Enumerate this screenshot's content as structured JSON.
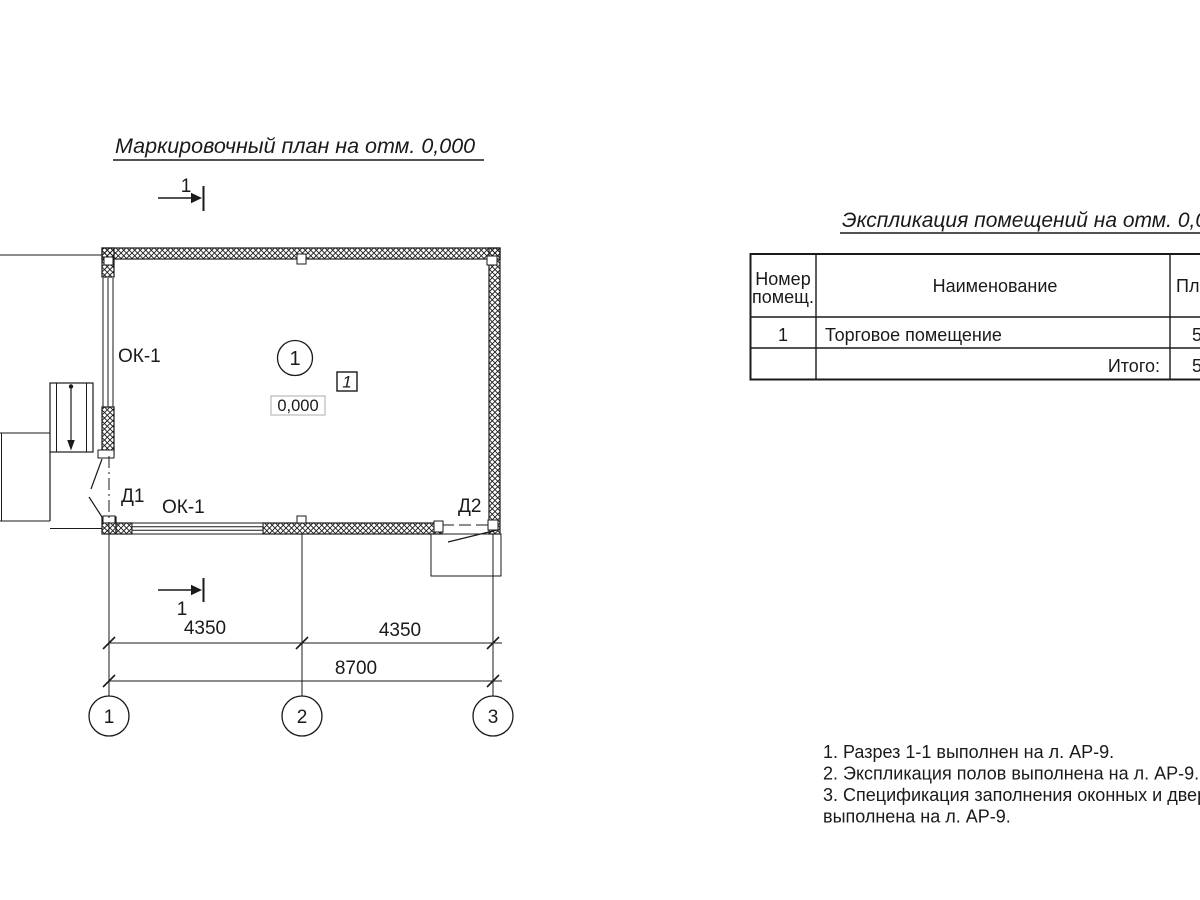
{
  "page": {
    "background": "#ffffff",
    "ink": "#1a1a1a"
  },
  "plan": {
    "title": "Маркировочный план на отм. 0,000",
    "section_marks": {
      "top": "1",
      "bottom": "1"
    },
    "room": {
      "circle_number": "1",
      "tag_number": "1",
      "elevation": "0,000"
    },
    "labels": {
      "window_left": "ОК-1",
      "window_bottom": "ОК-1",
      "door_1": "Д1",
      "door_2": "Д2"
    },
    "dimensions": {
      "left": "4350",
      "right": "4350",
      "total": "8700"
    },
    "axes": {
      "a1": "1",
      "a2": "2",
      "a3": "3"
    }
  },
  "table": {
    "title": "Экспликация помещений на отм. 0,000",
    "header": {
      "room_no_line1": "Номер",
      "room_no_line2": "помещ.",
      "name": "Наименование",
      "area": "Площадь"
    },
    "rows": {
      "r1": {
        "no": "1",
        "name": "Торговое помещение",
        "area": "5"
      },
      "total": {
        "label": "Итого:",
        "area": "5"
      }
    }
  },
  "notes": {
    "line1": "1. Разрез 1-1 выполнен на л. АР-9.",
    "line2": "2. Экспликация полов выполнена на л. АР-9.",
    "line3": "3. Спецификация заполнения оконных и дверных",
    "line4": "выполнена  на л. АР-9."
  }
}
